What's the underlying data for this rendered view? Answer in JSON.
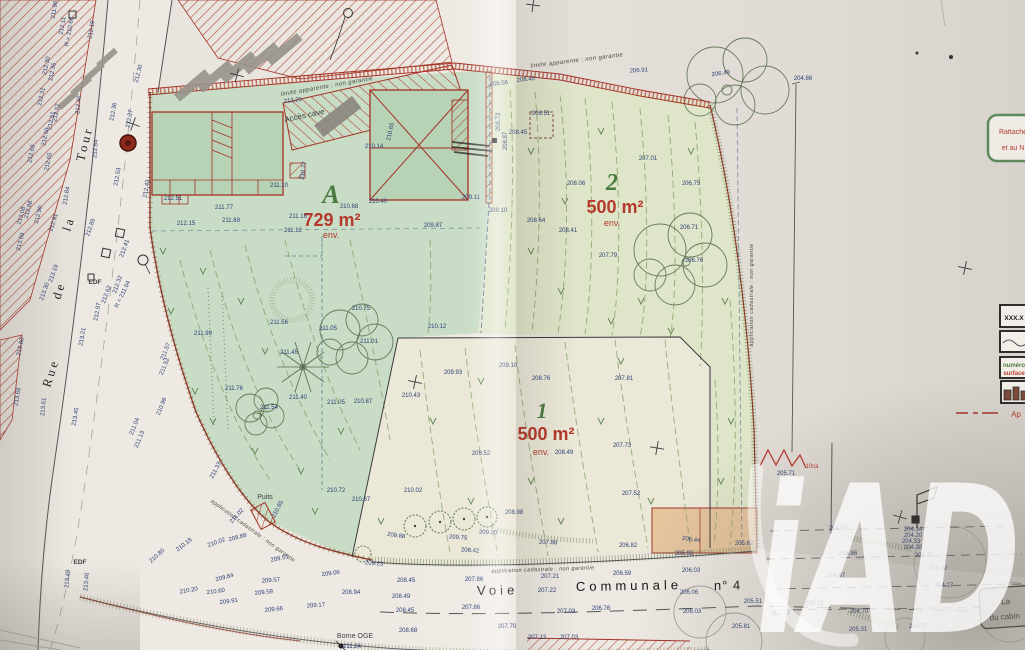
{
  "plan": {
    "watermark": "iAD",
    "streets": {
      "left": [
        "Rue",
        "de",
        "la",
        "Tour"
      ],
      "bottom": [
        "Voie",
        "Communale",
        "n° 4"
      ]
    },
    "parcels": [
      {
        "id": "A",
        "area": "729 m²",
        "approx": "env."
      },
      {
        "id": "2",
        "area": "500 m²",
        "approx": "env."
      },
      {
        "id": "1",
        "area": "500 m²",
        "approx": "env."
      }
    ],
    "annotations": {
      "limit_top_a": "limite apparente : non garantie",
      "limit_top_2": "limite apparente : non garantie",
      "cadastral_right": "application cadastrale : non garantie",
      "cadastral_bottom": "application cadastrale : non garantie",
      "cadastral_southwest": "application cadastrale : non garantie",
      "acces_cave": "Accès cave",
      "puits": "Puits",
      "borne_oge": "Borne OGE",
      "borne_alt": "211.24",
      "edf_upper": "EDF",
      "edf_lower": "EDF",
      "loca": "10ca"
    },
    "notes": {
      "side_box": [
        "Rattaché",
        "et au N"
      ],
      "corner_box": [
        "La",
        "du cabin"
      ]
    },
    "legend": {
      "alt_sample": "XXX.X",
      "parcel_number": "numéro",
      "parcel_surface": "surface",
      "below": "Ap"
    },
    "colors": {
      "parcel_green": "#c9dcc6",
      "parcel_yellow": "#dfe5c9",
      "parcel_cream": "#ebe8d8",
      "shed_orange": "#e5c49e",
      "boundary_red": "#a33225",
      "elevation_blue": "#2b3e75",
      "area_red": "#b5392c",
      "parcel_id_green": "#4a7a3f"
    },
    "elevations": [
      {
        "v": "211.96",
        "x": 56,
        "y": 10,
        "r": -80
      },
      {
        "v": "212.19",
        "x": 93,
        "y": 30,
        "r": -80
      },
      {
        "v": "212.11",
        "x": 64,
        "y": 26,
        "r": -80
      },
      {
        "v": "R = 210.66",
        "x": 71,
        "y": 32,
        "r": -80
      },
      {
        "v": "212.30",
        "x": 48,
        "y": 66,
        "r": -78
      },
      {
        "v": "212.35",
        "x": 54,
        "y": 72,
        "r": -78
      },
      {
        "v": "212.31",
        "x": 43,
        "y": 97,
        "r": -78
      },
      {
        "v": "212.46",
        "x": 80,
        "y": 105,
        "r": -85
      },
      {
        "v": "212.57",
        "x": 58,
        "y": 113,
        "r": -78
      },
      {
        "v": "212.51",
        "x": 53,
        "y": 121,
        "r": -78
      },
      {
        "v": "212.56",
        "x": 47,
        "y": 137,
        "r": -78
      },
      {
        "v": "212.64",
        "x": 97,
        "y": 149,
        "r": -85
      },
      {
        "v": "212.65",
        "x": 50,
        "y": 162,
        "r": -78
      },
      {
        "v": "212.69",
        "x": 33,
        "y": 154,
        "r": -78
      },
      {
        "v": "212.84",
        "x": 68,
        "y": 196,
        "r": -80
      },
      {
        "v": "212.88",
        "x": 30,
        "y": 210,
        "r": -75
      },
      {
        "v": "212.90",
        "x": 40,
        "y": 215,
        "r": -75
      },
      {
        "v": "212.91",
        "x": 55,
        "y": 223,
        "r": -72
      },
      {
        "v": "213.08",
        "x": 23,
        "y": 216,
        "r": -75
      },
      {
        "v": "213.09",
        "x": 22,
        "y": 242,
        "r": -75
      },
      {
        "v": "212.85",
        "x": 92,
        "y": 228,
        "r": -70
      },
      {
        "v": "213.19",
        "x": 55,
        "y": 274,
        "r": -70
      },
      {
        "v": "213.30",
        "x": 46,
        "y": 292,
        "r": -70
      },
      {
        "v": "213.80",
        "x": 22,
        "y": 347,
        "r": -78
      },
      {
        "v": "213.68",
        "x": 19,
        "y": 397,
        "r": -80
      },
      {
        "v": "213.61",
        "x": 45,
        "y": 407,
        "r": -85
      },
      {
        "v": "213.49",
        "x": 69,
        "y": 579,
        "r": -85
      },
      {
        "v": "213.46",
        "x": 88,
        "y": 582,
        "r": -85
      },
      {
        "v": "213.21",
        "x": 84,
        "y": 337,
        "r": -80
      },
      {
        "v": "212.97",
        "x": 99,
        "y": 312,
        "r": -80
      },
      {
        "v": "212.62",
        "x": 108,
        "y": 295,
        "r": -70
      },
      {
        "v": "212.32",
        "x": 119,
        "y": 285,
        "r": -70
      },
      {
        "v": "R = 211.64",
        "x": 124,
        "y": 295,
        "r": -65
      },
      {
        "v": "212.41",
        "x": 126,
        "y": 249,
        "r": -70
      },
      {
        "v": "212.36",
        "x": 115,
        "y": 112,
        "r": -80
      },
      {
        "v": "212.27",
        "x": 131,
        "y": 119,
        "r": -80
      },
      {
        "v": "212.30",
        "x": 140,
        "y": 74,
        "r": -75
      },
      {
        "v": "212.53",
        "x": 119,
        "y": 177,
        "r": -80
      },
      {
        "v": "212.43",
        "x": 148,
        "y": 189,
        "r": -80
      },
      {
        "v": "211.57",
        "x": 167,
        "y": 352,
        "r": -68
      },
      {
        "v": "211.52",
        "x": 166,
        "y": 367,
        "r": -68
      },
      {
        "v": "210.99",
        "x": 163,
        "y": 407,
        "r": -68
      },
      {
        "v": "211.04",
        "x": 136,
        "y": 427,
        "r": -68
      },
      {
        "v": "213.45",
        "x": 77,
        "y": 417,
        "r": -80
      },
      {
        "v": "211.13",
        "x": 141,
        "y": 440,
        "r": -68
      },
      {
        "v": "210.18",
        "x": 185,
        "y": 546,
        "r": -38
      },
      {
        "v": "210.02",
        "x": 217,
        "y": 544,
        "r": -20
      },
      {
        "v": "209.88",
        "x": 238,
        "y": 539,
        "r": -15
      },
      {
        "v": "210.80",
        "x": 158,
        "y": 557,
        "r": -42
      },
      {
        "v": "209.51",
        "x": 280,
        "y": 560,
        "r": -12
      },
      {
        "v": "209.84",
        "x": 225,
        "y": 579,
        "r": -15
      },
      {
        "v": "210.20",
        "x": 189,
        "y": 592,
        "r": -10
      },
      {
        "v": "210.60",
        "x": 216,
        "y": 593,
        "r": -8
      },
      {
        "v": "209.91",
        "x": 229,
        "y": 603,
        "r": -8
      },
      {
        "v": "209.57",
        "x": 271,
        "y": 582,
        "r": -5
      },
      {
        "v": "209.59",
        "x": 264,
        "y": 594,
        "r": -6
      },
      {
        "v": "209.66",
        "x": 274,
        "y": 611,
        "r": -6
      },
      {
        "v": "209.17",
        "x": 316,
        "y": 607,
        "r": -4
      },
      {
        "v": "209.06",
        "x": 331,
        "y": 575,
        "r": -8
      },
      {
        "v": "208.94",
        "x": 351,
        "y": 594
      },
      {
        "v": "208.45",
        "x": 406,
        "y": 582
      },
      {
        "v": "207.86",
        "x": 474,
        "y": 581
      },
      {
        "v": "207.21",
        "x": 550,
        "y": 578
      },
      {
        "v": "206.59",
        "x": 622,
        "y": 575
      },
      {
        "v": "206.03",
        "x": 691,
        "y": 572
      },
      {
        "v": "208.49",
        "x": 401,
        "y": 598
      },
      {
        "v": "207.22",
        "x": 547,
        "y": 592
      },
      {
        "v": "206.06",
        "x": 689,
        "y": 594
      },
      {
        "v": "208.45",
        "x": 405,
        "y": 612
      },
      {
        "v": "207.86",
        "x": 471,
        "y": 609
      },
      {
        "v": "207.03",
        "x": 566,
        "y": 613
      },
      {
        "v": "206.76",
        "x": 601,
        "y": 610
      },
      {
        "v": "206.03",
        "x": 692,
        "y": 613
      },
      {
        "v": "205.51",
        "x": 753,
        "y": 603
      },
      {
        "v": "205.81",
        "x": 741,
        "y": 628
      },
      {
        "v": "208.68",
        "x": 408,
        "y": 632
      },
      {
        "v": "207.70",
        "x": 507,
        "y": 628
      },
      {
        "v": "207.13",
        "x": 537,
        "y": 639
      },
      {
        "v": "207.03",
        "x": 569,
        "y": 639
      },
      {
        "v": "205.93",
        "x": 684,
        "y": 555
      },
      {
        "v": "205.62",
        "x": 744,
        "y": 545
      },
      {
        "v": "206.44",
        "x": 691,
        "y": 541,
        "r": 8
      },
      {
        "v": "209.88",
        "x": 396,
        "y": 537,
        "r": 8
      },
      {
        "v": "209.75",
        "x": 458,
        "y": 539,
        "r": 5
      },
      {
        "v": "209.20",
        "x": 488,
        "y": 534,
        "r": 3
      },
      {
        "v": "208.98",
        "x": 514,
        "y": 514
      },
      {
        "v": "208.42",
        "x": 470,
        "y": 552,
        "r": 4
      },
      {
        "v": "207.88",
        "x": 548,
        "y": 544,
        "r": 2
      },
      {
        "v": "206.82",
        "x": 628,
        "y": 547
      },
      {
        "v": "209.93",
        "x": 453,
        "y": 374
      },
      {
        "v": "209.10",
        "x": 508,
        "y": 367
      },
      {
        "v": "208.76",
        "x": 541,
        "y": 380
      },
      {
        "v": "207.81",
        "x": 624,
        "y": 380
      },
      {
        "v": "210.43",
        "x": 411,
        "y": 397
      },
      {
        "v": "209.52",
        "x": 481,
        "y": 455
      },
      {
        "v": "208.49",
        "x": 564,
        "y": 454
      },
      {
        "v": "207.73",
        "x": 622,
        "y": 447
      },
      {
        "v": "207.52",
        "x": 631,
        "y": 495
      },
      {
        "v": "210.02",
        "x": 413,
        "y": 492
      },
      {
        "v": "210.12",
        "x": 437,
        "y": 328
      },
      {
        "v": "207.01",
        "x": 648,
        "y": 160
      },
      {
        "v": "206.75",
        "x": 691,
        "y": 185
      },
      {
        "v": "206.71",
        "x": 689,
        "y": 229
      },
      {
        "v": "207.79",
        "x": 608,
        "y": 257
      },
      {
        "v": "206.76",
        "x": 694,
        "y": 262
      },
      {
        "v": "206.91",
        "x": 639,
        "y": 72,
        "r": -4
      },
      {
        "v": "206.49",
        "x": 721,
        "y": 75,
        "r": -8
      },
      {
        "v": "204.86",
        "x": 803,
        "y": 80
      },
      {
        "v": "208.06",
        "x": 576,
        "y": 185
      },
      {
        "v": "208.41",
        "x": 568,
        "y": 232
      },
      {
        "v": "208.64",
        "x": 536,
        "y": 222
      },
      {
        "v": "209.10",
        "x": 498,
        "y": 212
      },
      {
        "v": "209.87",
        "x": 433,
        "y": 227
      },
      {
        "v": "208.56",
        "x": 499,
        "y": 85,
        "r": -6
      },
      {
        "v": "208.40",
        "x": 526,
        "y": 81,
        "r": -6
      },
      {
        "v": "208.51",
        "x": 541,
        "y": 115
      },
      {
        "v": "208.45",
        "x": 518,
        "y": 134
      },
      {
        "v": "208.73",
        "x": 500,
        "y": 122,
        "r": -90
      },
      {
        "v": "208.87",
        "x": 507,
        "y": 141,
        "r": -90
      },
      {
        "v": "209.11",
        "x": 471,
        "y": 199
      },
      {
        "v": "212.25",
        "x": 293,
        "y": 102,
        "r": -6
      },
      {
        "v": "210.14",
        "x": 374,
        "y": 148
      },
      {
        "v": "210.40",
        "x": 378,
        "y": 203
      },
      {
        "v": "210.68",
        "x": 349,
        "y": 208
      },
      {
        "v": "210.65",
        "x": 392,
        "y": 132,
        "r": -78
      },
      {
        "v": "211.16",
        "x": 298,
        "y": 218
      },
      {
        "v": "211.10",
        "x": 279,
        "y": 187
      },
      {
        "v": "210.77",
        "x": 305,
        "y": 171,
        "r": -80
      },
      {
        "v": "212.51",
        "x": 173,
        "y": 200
      },
      {
        "v": "211.77",
        "x": 224,
        "y": 209
      },
      {
        "v": "211.69",
        "x": 231,
        "y": 222
      },
      {
        "v": "212.15",
        "x": 186,
        "y": 225
      },
      {
        "v": "211.12",
        "x": 293,
        "y": 232
      },
      {
        "v": "211.99",
        "x": 203,
        "y": 335
      },
      {
        "v": "211.56",
        "x": 279,
        "y": 324
      },
      {
        "v": "211.45",
        "x": 289,
        "y": 354
      },
      {
        "v": "211.05",
        "x": 328,
        "y": 330
      },
      {
        "v": "211.01",
        "x": 369,
        "y": 343
      },
      {
        "v": "210.75",
        "x": 361,
        "y": 310
      },
      {
        "v": "211.76",
        "x": 234,
        "y": 390
      },
      {
        "v": "211.54",
        "x": 269,
        "y": 409
      },
      {
        "v": "211.40",
        "x": 298,
        "y": 399
      },
      {
        "v": "211.05",
        "x": 336,
        "y": 404
      },
      {
        "v": "210.87",
        "x": 363,
        "y": 403
      },
      {
        "v": "210.72",
        "x": 336,
        "y": 492
      },
      {
        "v": "210.87",
        "x": 361,
        "y": 501
      },
      {
        "v": "210.85",
        "x": 279,
        "y": 510,
        "r": -62
      },
      {
        "v": "211.33",
        "x": 217,
        "y": 471,
        "r": -62
      },
      {
        "v": "211.02",
        "x": 238,
        "y": 517,
        "r": -48
      },
      {
        "v": "209.23",
        "x": 374,
        "y": 565,
        "r": 5
      },
      {
        "v": "205.71",
        "x": 786,
        "y": 475
      },
      {
        "v": "204.97",
        "x": 838,
        "y": 530
      },
      {
        "v": "204.86",
        "x": 848,
        "y": 555
      },
      {
        "v": "204.34",
        "x": 913,
        "y": 531
      },
      {
        "v": "204.20",
        "x": 913,
        "y": 537
      },
      {
        "v": "204.33",
        "x": 911,
        "y": 543
      },
      {
        "v": "204.38",
        "x": 913,
        "y": 549
      },
      {
        "v": "204.31",
        "x": 924,
        "y": 557
      },
      {
        "v": "204.32",
        "x": 938,
        "y": 570
      },
      {
        "v": "204.27",
        "x": 944,
        "y": 587
      },
      {
        "v": "204.87",
        "x": 836,
        "y": 577
      },
      {
        "v": "204.70",
        "x": 859,
        "y": 613
      },
      {
        "v": "205.31",
        "x": 858,
        "y": 631
      },
      {
        "v": "205.13",
        "x": 814,
        "y": 605
      },
      {
        "v": "205.37",
        "x": 781,
        "y": 615
      },
      {
        "v": "204.75",
        "x": 918,
        "y": 628
      }
    ]
  }
}
